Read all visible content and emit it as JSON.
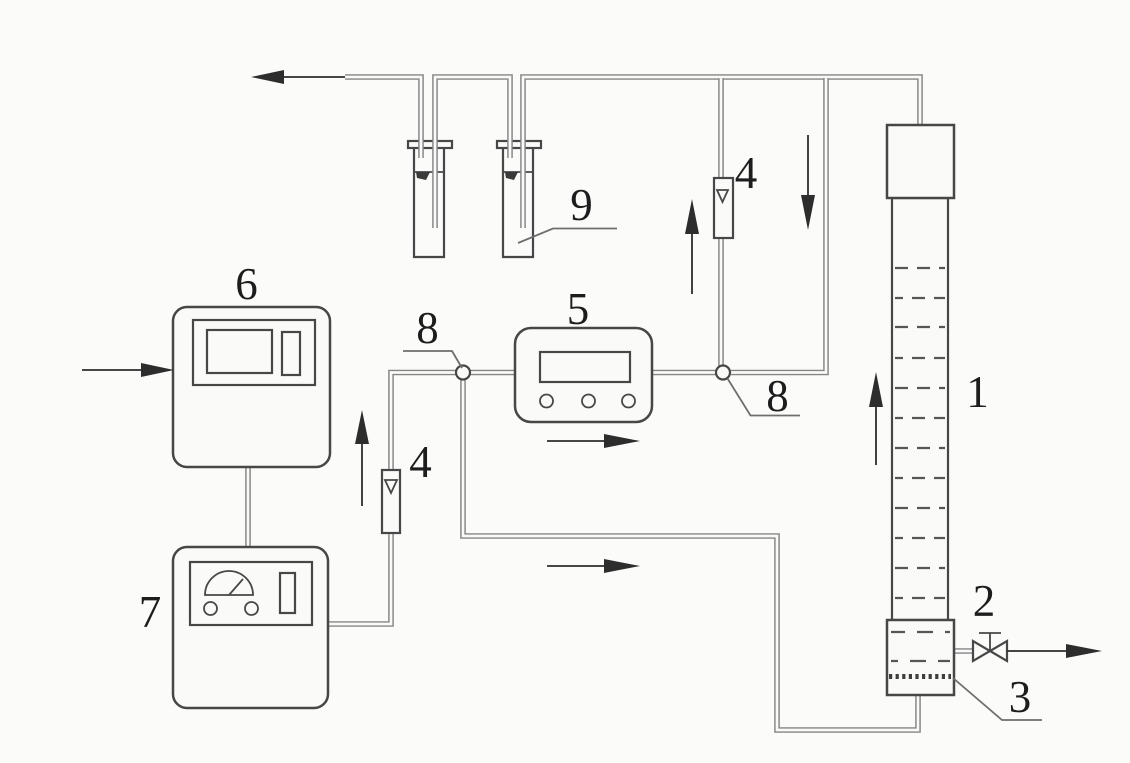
{
  "colors": {
    "background": "#fbfbfa",
    "pipe": "#858585",
    "outline": "#474747",
    "arrow": "#2d2d2d",
    "label": "#1d1d1d"
  },
  "labels": {
    "column": "1",
    "valve": "2",
    "distributor": "3",
    "flowmeter_left": "4",
    "flowmeter_right": "4",
    "meter": "5",
    "controller": "6",
    "power_unit": "7",
    "junction_left": "8",
    "junction_right": "8",
    "bottles": "9"
  }
}
